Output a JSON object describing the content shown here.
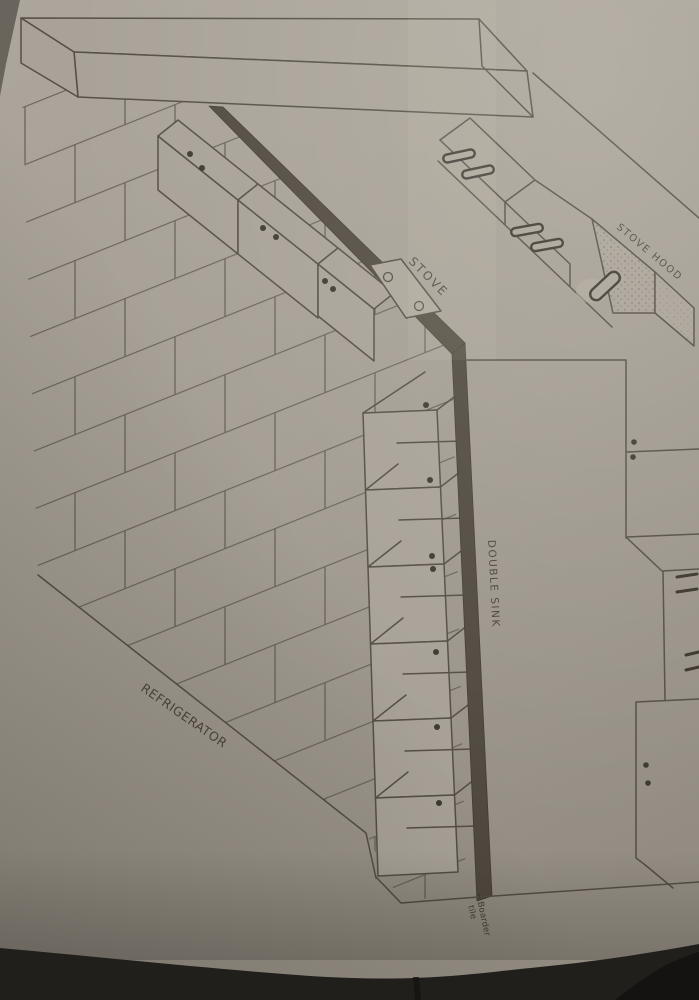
{
  "labels": {
    "stove": "STOVE",
    "stove_hood": "STOVE HOOD",
    "double_sink": "DOUBLE SINK",
    "refrigerator": "REFRIGERATOR",
    "note_arrow": "←",
    "note_line1": "Boarder",
    "note_line2": "tile"
  },
  "colors": {
    "paper": "#a49e94",
    "pencil": "#4e4840",
    "dark_tile": "#4a4339",
    "photo_background": "#211f1c"
  }
}
